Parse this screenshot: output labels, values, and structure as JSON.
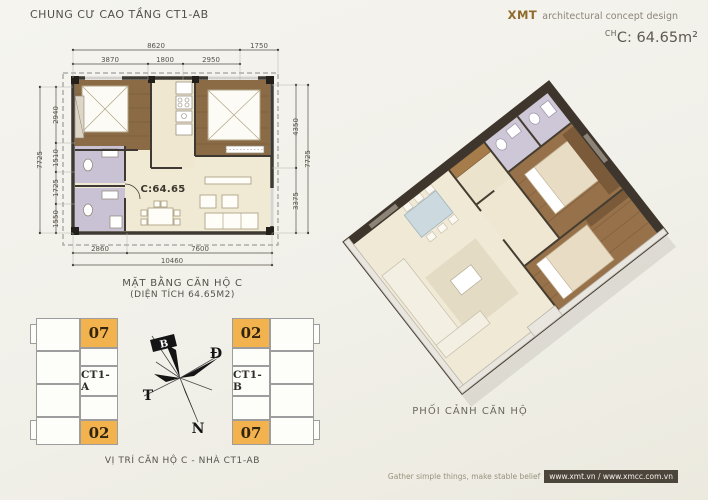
{
  "header": {
    "title": "CHUNG CƯ CAO TẦNG CT1-AB",
    "brand": "XMT",
    "brand_tagline": "architectural concept design",
    "unit_code_sup": "CH",
    "unit_area": "C: 64.65m²"
  },
  "floor_plan": {
    "room_label": "C:64.65",
    "caption_line1": "MẶT BẰNG CĂN HỘ C",
    "caption_line2": "(DIỆN TÍCH 64.65M2)",
    "dims_top": {
      "total": "8620",
      "right": "1750",
      "segments": [
        "3870",
        "1800",
        "2950"
      ]
    },
    "dims_left": {
      "total": "7725",
      "segments": [
        "2940",
        "1510",
        "1725",
        "1550"
      ]
    },
    "dims_right": {
      "total": "7725",
      "segments": [
        "4350",
        "3375"
      ]
    },
    "dims_bottom": {
      "total": "10460",
      "segments": [
        "2860",
        "7600"
      ]
    }
  },
  "locator": {
    "left_building": {
      "label": "CT1-A",
      "top_unit": "07",
      "bottom_unit": "02"
    },
    "right_building": {
      "label": "CT1-B",
      "top_unit": "02",
      "bottom_unit": "07"
    },
    "compass": {
      "north": "B",
      "east": "Đ",
      "west": "T",
      "south": "N"
    },
    "caption": "VỊ TRÍ CĂN HỘ C - NHÀ CT1-AB"
  },
  "perspective": {
    "caption": "PHỐI CẢNH CĂN HỘ"
  },
  "footer": {
    "slogan": "Gather simple things, make stable belief",
    "websites": "www.xmt.vn / www.xmcc.com.vn"
  },
  "colors": {
    "highlight_orange": "#F2B34E",
    "brand_brown": "#8E6B2B",
    "wood_floor": "#8A6B45",
    "unit_floor": "#F0E9D4",
    "bathroom": "#C9C2D4",
    "wall_dark": "#3E3A33"
  }
}
